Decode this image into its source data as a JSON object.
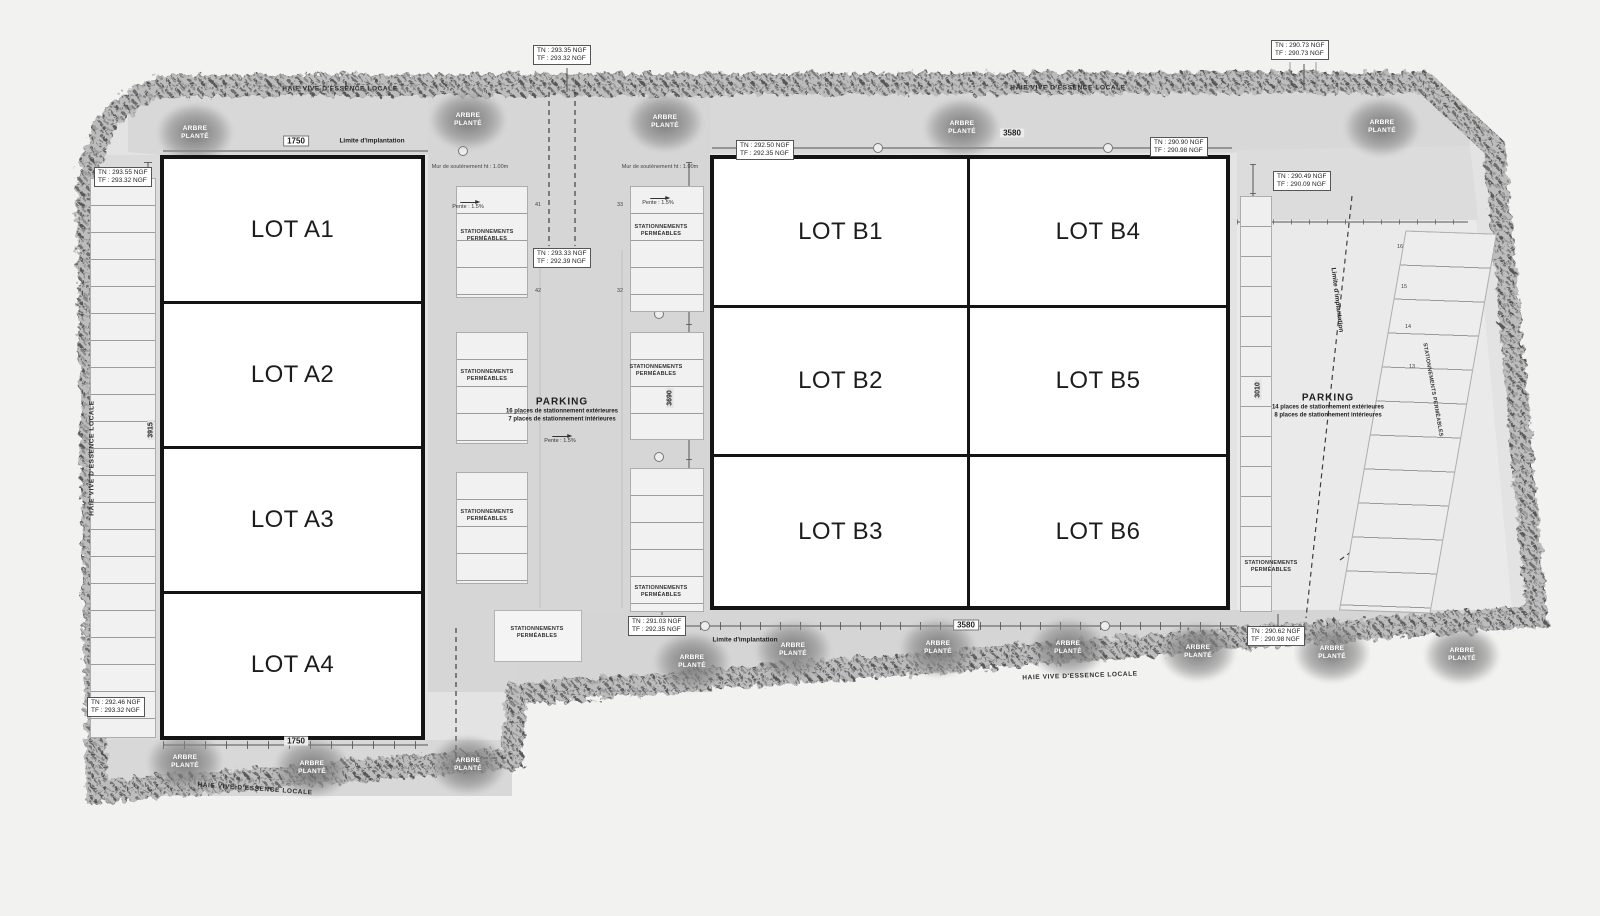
{
  "plan": {
    "buildings": {
      "a": {
        "lots": [
          {
            "label": "LOT A1"
          },
          {
            "label": "LOT A2"
          },
          {
            "label": "LOT A3"
          },
          {
            "label": "LOT A4"
          }
        ]
      },
      "b": {
        "lots": [
          {
            "label": "LOT B1"
          },
          {
            "label": "LOT B4"
          },
          {
            "label": "LOT B2"
          },
          {
            "label": "LOT B5"
          },
          {
            "label": "LOT B3"
          },
          {
            "label": "LOT B6"
          }
        ]
      }
    },
    "parking_center": {
      "title": "PARKING",
      "line1": "16 places de stationnement extérieures",
      "line2": "7 places de stationnement intérieures"
    },
    "parking_right": {
      "title": "PARKING",
      "line1": "14 places de stationnement extérieures",
      "line2": "8 places de stationnement intérieures"
    },
    "elevations": [
      {
        "id": "top-center",
        "tn": "TN : 293.35 NGF",
        "tf": "TF : 293.32 NGF"
      },
      {
        "id": "top-right",
        "tn": "TN : 290.73 NGF",
        "tf": "TF : 290.73 NGF"
      },
      {
        "id": "left-upper",
        "tn": "TN : 293.55 NGF",
        "tf": "TF : 293.32 NGF"
      },
      {
        "id": "b-top-left",
        "tn": "TN : 292.50 NGF",
        "tf": "TF : 292.35 NGF"
      },
      {
        "id": "b-top-right",
        "tn": "TN : 290.90 NGF",
        "tf": "TF : 290.98 NGF"
      },
      {
        "id": "right-upper",
        "tn": "TN : 290.49 NGF",
        "tf": "TF : 290.09 NGF"
      },
      {
        "id": "center-mid",
        "tn": "TN : 293.33 NGF",
        "tf": "TF : 292.39 NGF"
      },
      {
        "id": "b-bottom-left",
        "tn": "TN : 291.03 NGF",
        "tf": "TF : 292.35 NGF"
      },
      {
        "id": "b-bottom-right",
        "tn": "TN : 290.62 NGF",
        "tf": "TF : 290.98 NGF"
      },
      {
        "id": "left-lower",
        "tn": "TN : 292.46 NGF",
        "tf": "TF : 293.32 NGF"
      }
    ],
    "dimensions": {
      "top_left": "1750",
      "top_b": "3580",
      "bottom_a": "1750",
      "bottom_b": "3580",
      "left_vertical": "3915",
      "center_vertical": "3690",
      "right_vertical": "3010"
    },
    "annotations": {
      "hedge": "HAIE VIVE D'ESSENCE LOCALE",
      "tree": "ARBRE PLANTÉ",
      "limite": "Limite d'implantation",
      "stationnements": "STATIONNEMENTS PERMÉABLES",
      "pente": "Pente : 1.5%",
      "mur": "Mur de soutènement ht : 1.00m"
    },
    "stall_numbers": {
      "cl_top": "41",
      "cl_bottom": "42",
      "cr_top": "33",
      "cr_bottom": "32",
      "right": [
        "16",
        "15",
        "14",
        "13"
      ]
    }
  }
}
